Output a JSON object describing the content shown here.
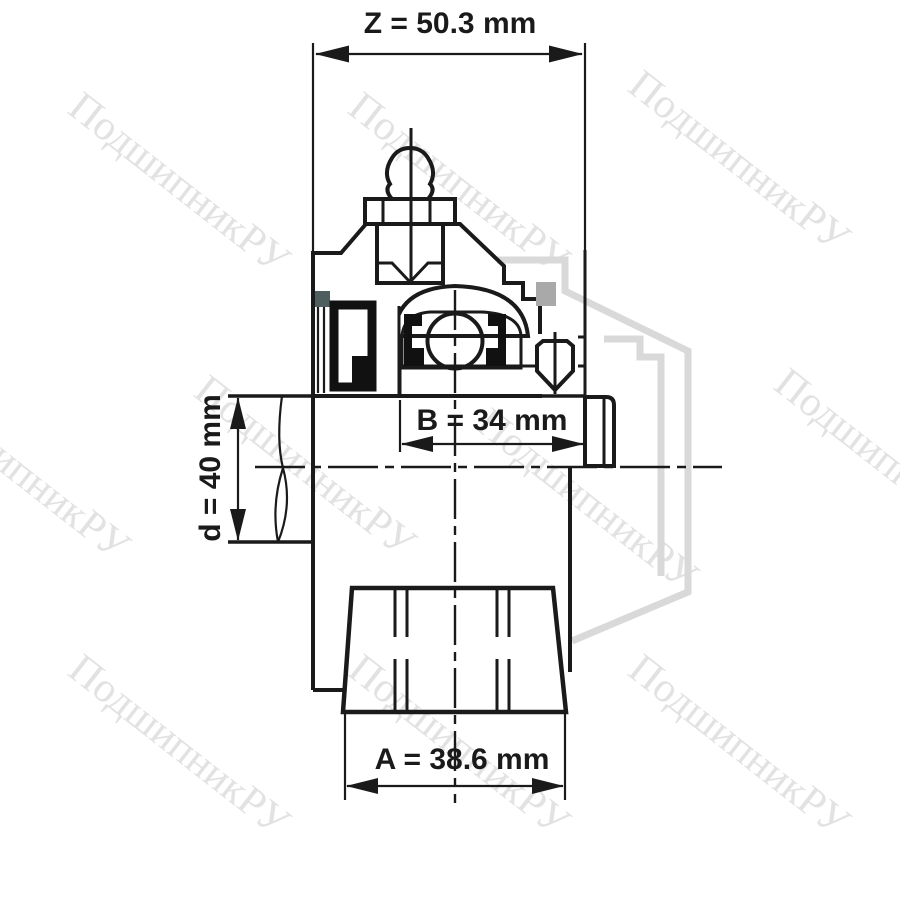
{
  "watermark": {
    "text": "ПодшипникРУ",
    "color": "#e2e2e2"
  },
  "dimensions": {
    "z": {
      "label": "Z = 50.3 mm"
    },
    "b": {
      "label": "B = 34 mm"
    },
    "d": {
      "label": "d = 40 mm"
    },
    "a": {
      "label": "A = 38.6 mm"
    }
  },
  "colors": {
    "outline": "#1a1a1a",
    "housing": "#c8c8c8",
    "cavity": "#ebefeb",
    "seal": "#111111",
    "slate": "#4e5e5e",
    "ghost": "#d9d9d9",
    "overlap": "#a9a9a9",
    "screw": "#c2c2c2",
    "background": "#ffffff"
  }
}
